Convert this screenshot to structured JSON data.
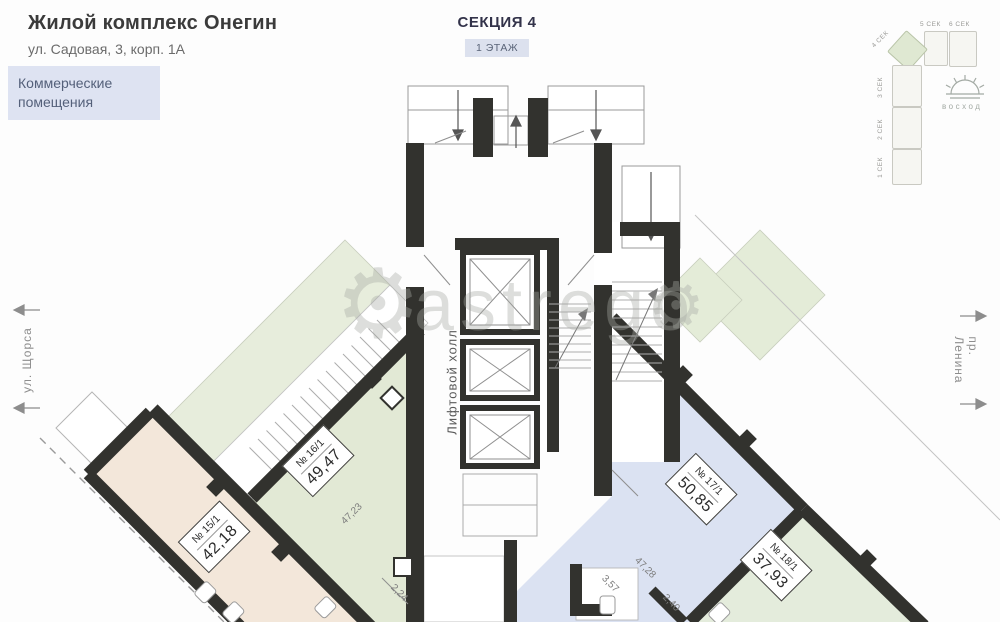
{
  "header": {
    "title": "Жилой комплекс Онегин",
    "subtitle": "ул. Садовая, 3, корп. 1А",
    "category": "Коммерческие помещения"
  },
  "section": {
    "title": "СЕКЦИЯ 4",
    "floor": "1 ЭТАЖ"
  },
  "streets": {
    "left": "ул. Щорса",
    "right": "пр. Ленина"
  },
  "minimap": {
    "sections": [
      {
        "label": "1 СЕК"
      },
      {
        "label": "2 СЕК"
      },
      {
        "label": "3 СЕК"
      },
      {
        "label": "4 СЕК"
      },
      {
        "label": "5 СЕК"
      },
      {
        "label": "6 СЕК"
      }
    ],
    "highlighted": "4 СЕК",
    "logo": "восход"
  },
  "plan": {
    "core_label": "Лифтовой холл",
    "apartments": [
      {
        "number": "№ 15/1",
        "area": "42,18",
        "color": "#f3e7da"
      },
      {
        "number": "№ 16/1",
        "area": "49,47",
        "color": "#e2e9d5"
      },
      {
        "number": "№ 17/1",
        "area": "50,85",
        "color": "#dbe2f2"
      },
      {
        "number": "№ 18/1",
        "area": "37,93",
        "color": "#e4ecdc"
      }
    ],
    "dimensions": [
      "47,23",
      "2,24",
      "3,57",
      "47,28",
      "2,40"
    ]
  },
  "watermark": {
    "text": "astrego"
  },
  "icons": {
    "gear": "⚙"
  },
  "colors": {
    "wall": "#32322e",
    "exterior_green": "#e7eddc",
    "porch_green": "#e4ecd8",
    "accent_box": "#dee3f2",
    "badge": "#dce1ee"
  }
}
